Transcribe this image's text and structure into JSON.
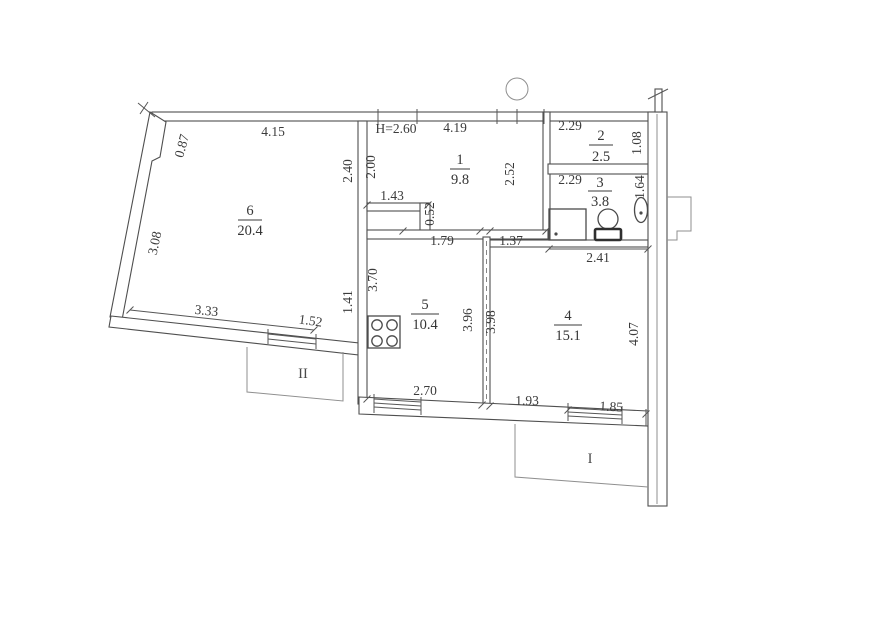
{
  "plan": {
    "ceiling_height_label": "H=2.60",
    "rooms": {
      "r1": {
        "number": "1",
        "area": "9.8"
      },
      "r2": {
        "number": "2",
        "area": "2.5"
      },
      "r3": {
        "number": "3",
        "area": "3.8"
      },
      "r4": {
        "number": "4",
        "area": "15.1"
      },
      "r5": {
        "number": "5",
        "area": "10.4"
      },
      "r6": {
        "number": "6",
        "area": "20.4"
      }
    },
    "balconies": {
      "loggia_1": {
        "label": "I"
      },
      "loggia_2": {
        "label": "II"
      }
    },
    "dimensions_m": {
      "room6_top": "4.15",
      "room6_upper_left": "0.87",
      "room6_left": "3.08",
      "room6_bottom": "3.33",
      "room6_right": "2.40",
      "room6_right_lower": "1.41",
      "room1_top": "4.19",
      "room1_left": "2.00",
      "room1_right": "2.52",
      "hall_step_width": "1.43",
      "hall_step_depth": "0.52",
      "room2_width": "2.29",
      "room2_depth": "1.08",
      "room3_width": "2.29",
      "room3_depth": "1.64",
      "room4_top_left": "1.37",
      "room4_top": "2.41",
      "room4_left": "3.98",
      "room4_right": "4.07",
      "room4_bottom_left": "1.93",
      "room4_bottom_right": "1.85",
      "room5_top": "1.79",
      "room5_left": "3.70",
      "room5_right": "3.96",
      "room5_bottom": "2.70",
      "balcony2_window": "1.52"
    },
    "colors": {
      "ink": "#3b3b3b",
      "wall": "#4f4f4f",
      "faint": "#8f8f8f",
      "paper": "#ffffff"
    }
  }
}
